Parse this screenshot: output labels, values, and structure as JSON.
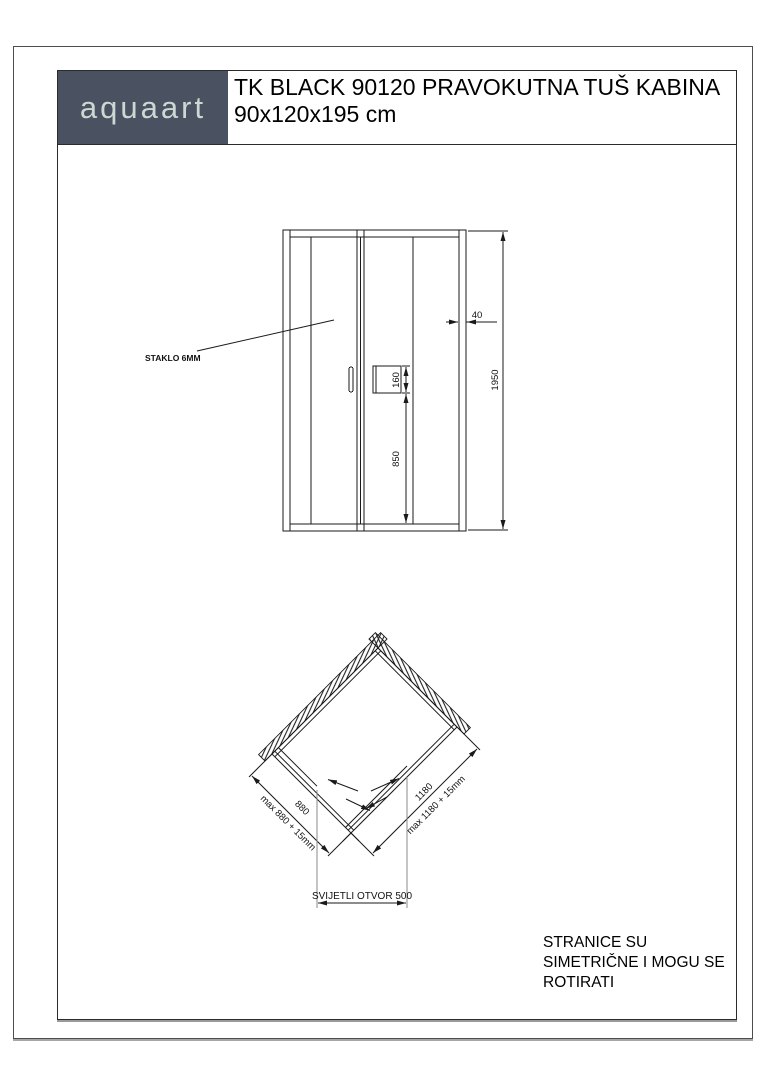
{
  "header": {
    "brand": "aquaart",
    "title_line1": "TK BLACK 90120 PRAVOKUTNA TUŠ KABINA",
    "title_line2": "90x120x195 cm"
  },
  "elevation": {
    "glass_label": "STAKLO 6MM",
    "dim_profile_width": "40",
    "dim_total_height": "1950",
    "dim_handle_height": "160",
    "dim_handle_from_floor": "850"
  },
  "plan": {
    "dim_side_left": "880",
    "dim_side_left_max": "max 880 + 15mm",
    "dim_side_right": "1180",
    "dim_side_right_max": "max 1180 + 15mm",
    "dim_opening": "SVIJETLI OTVOR 500"
  },
  "notes": {
    "line1": "STRANICE SU",
    "line2": "SIMETRIČNE I MOGU SE",
    "line3": "ROTIRATI"
  },
  "colors": {
    "brand_bg": "#4a5262",
    "brand_text": "#ccd8d1",
    "line": "#1a1a1a",
    "border_shadow": "#9a9a9a"
  }
}
